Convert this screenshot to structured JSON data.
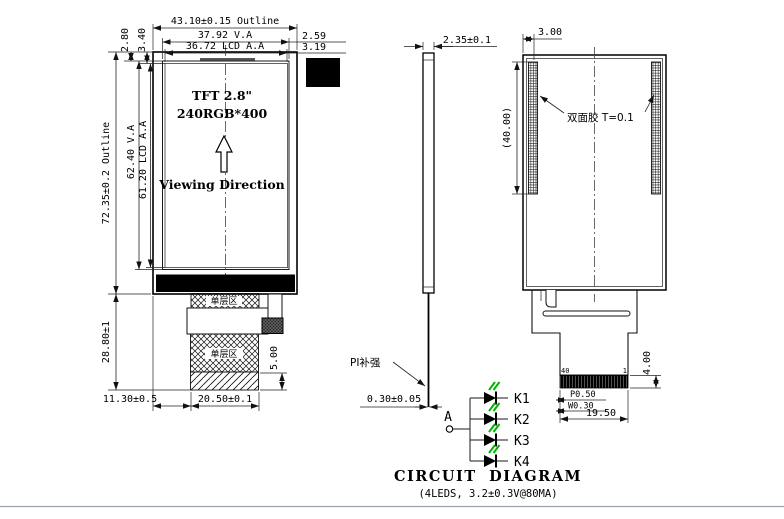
{
  "front_view": {
    "title": "TFT 2.8\"",
    "resolution": "240RGB*400",
    "viewing": "Viewing Direction",
    "single_layer_1": "单层区",
    "single_layer_2": "单层区",
    "dims": {
      "outline_w": "43.10±0.15 Outline",
      "va_w": "37.92 V.A",
      "aa_w": "36.72 LCD A.A",
      "off_va_right": "2.59",
      "off_aa_right": "3.19",
      "off_va_top": "2.80",
      "off_aa_top": "3.40",
      "outline_h": "72.35±0.2 Outline",
      "va_h": "62.40 V.A",
      "aa_h": "61.20 LCD A.A",
      "fpc_h": "28.80±1",
      "fpc_offset": "11.30±0.5",
      "fpc_w": "20.50±0.1",
      "stiffener_h": "5.00"
    }
  },
  "side_view": {
    "thickness": "2.35±0.1",
    "pi_label": "PI补强",
    "fpc_thickness": "0.30±0.05"
  },
  "back_view": {
    "tape_offset": "3.00",
    "tape_len": "(40.00)",
    "tape_label": "双面胶 T=0.1",
    "pin_first": "40",
    "pin_last": "1",
    "conn_h": "4.00",
    "pitch": "P0.50",
    "pin_w": "W0.30",
    "conn_w": "19.50"
  },
  "circuit": {
    "anode": "A",
    "leds": [
      "K1",
      "K2",
      "K3",
      "K4"
    ],
    "title": "CIRCUIT DIAGRAM",
    "subtitle": "(4LEDS, 3.2±0.3V@80MA)",
    "led_color": "#00b400",
    "line_color": "#1a1a1a"
  }
}
